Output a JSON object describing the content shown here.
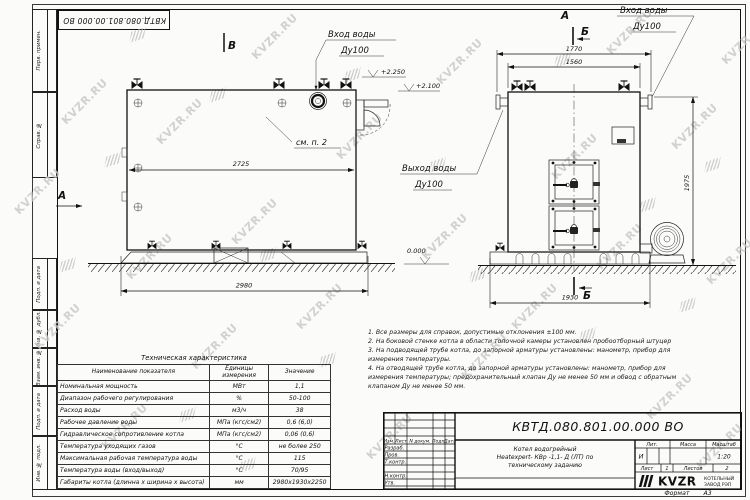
{
  "frame": {
    "left_strip_top": [
      "Перв. примен.",
      "Справ. №"
    ],
    "left_strip_bottom": [
      "Подп. и дата",
      "Инв. № дубл.",
      "Взам. инв. №",
      "Подп. и дата",
      "Инв. № подл."
    ],
    "format_label": "Формат",
    "format_value": "А3"
  },
  "watermark": {
    "text": "KVZR.RU"
  },
  "drawing": {
    "left_view": {
      "view_arrow": "А",
      "marker_b": "В",
      "inlet_line1": "Вход воды",
      "inlet_line2": "Ду100",
      "see_note": "см. п. 2",
      "level_top": "+2.250",
      "level_mid": "+2.100",
      "dim_inner": "2725",
      "dim_bottom": "2980"
    },
    "right_view": {
      "view_label": "А",
      "section_top": "Б",
      "section_bottom": "Б",
      "inlet_line1": "Вход воды",
      "inlet_line2": "Ду100",
      "outlet_line1": "Выход воды",
      "outlet_line2": "Ду100",
      "dim_top_outer": "1770",
      "dim_top_inner": "1560",
      "dim_height": "1975",
      "dim_bottom": "1930",
      "level_zero": "0.000"
    }
  },
  "specs": {
    "title": "Техническая характеристика",
    "headers": [
      "Наименование показателя",
      "Единицы измерения",
      "Значение"
    ],
    "rows": [
      [
        "Номинальная мощность",
        "МВт",
        "1,1"
      ],
      [
        "Диапазон рабочего регулирования",
        "%",
        "50-100"
      ],
      [
        "Расход воды",
        "м3/ч",
        "38"
      ],
      [
        "Рабочее давление воды",
        "МПа (кгс/см2)",
        "0,6 (6,0)"
      ],
      [
        "Гидравлическое сопротивление котла",
        "МПа (кгс/см2)",
        "0,06 (0,6)"
      ],
      [
        "Температура уходящих газов",
        "°С",
        "не более 250"
      ],
      [
        "Максимальная рабочая температура воды",
        "°С",
        "115"
      ],
      [
        "Температура воды (вход/выход)",
        "°С",
        "70/95"
      ],
      [
        "Габариты котла (длинна х ширина х высота)",
        "мм",
        "2980х1930х2250"
      ]
    ]
  },
  "notes": [
    "1. Все размеры для справок, допустимые отклонения ±100 мм.",
    "2. На боковой стенке котла в области топочной камеры установлен пробоотборный штуцер",
    "3. На подводящей трубе котла, до запорной арматуры установлены: манометр, прибор для измерения температуры.",
    "4. На отводящей трубе котла, до запорной арматуры установлены: манометр, прибор для измерения температуры; предохранительный клапан Ду не менее 50 мм и обвод с обратным клапаном Ду не менее 50 мм."
  ],
  "title_block": {
    "doc_number": "КВТД.080.801.00.000  ВО",
    "columns": [
      "Изм.",
      "Лист",
      "N докум.",
      "Подп.",
      "Дата"
    ],
    "sign_rows": [
      "Разраб.",
      "Пров.",
      "Т.контр.",
      "Н.контр.",
      "Утв."
    ],
    "description": [
      "Котел водогрейный",
      "Heatexpert- КВр -1,1- Д (ЛТ) по",
      "техническому заданию"
    ],
    "lit_header": "Лит.",
    "mass_header": "Масса",
    "scale_header": "Масштаб",
    "lit_value": "И",
    "scale_value": "1:20",
    "sheet_label": "Лист",
    "sheet_value": "1",
    "sheets_label": "Листов",
    "sheets_value": "2",
    "company_logo": "KVZR",
    "company_line1": "КОТЕЛЬНЫЙ",
    "company_line2": "ЗАВОД РЭП"
  }
}
